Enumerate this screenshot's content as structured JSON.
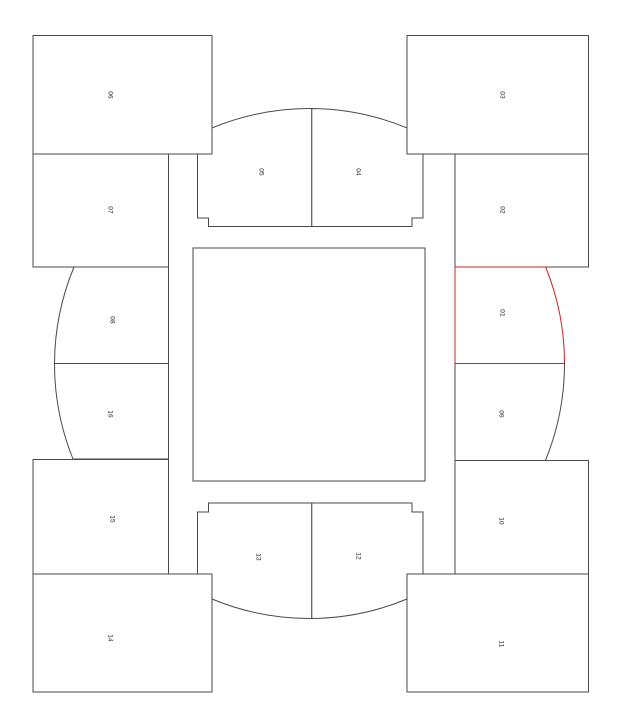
{
  "map": {
    "title": "venue-seating-map",
    "highlighted_section": "01",
    "field_label": ""
  },
  "colors": {
    "line": "#4a4a4a",
    "highlight": "#cc2525",
    "label": "#222222",
    "background": "#ffffff"
  },
  "sections": [
    {
      "id": "01",
      "label": "01",
      "highlighted": true
    },
    {
      "id": "02",
      "label": "02"
    },
    {
      "id": "03",
      "label": "03"
    },
    {
      "id": "04",
      "label": "04"
    },
    {
      "id": "05",
      "label": "05"
    },
    {
      "id": "06",
      "label": "06"
    },
    {
      "id": "07",
      "label": "07"
    },
    {
      "id": "08",
      "label": "08"
    },
    {
      "id": "09",
      "label": "09"
    },
    {
      "id": "10",
      "label": "10"
    },
    {
      "id": "11",
      "label": "11"
    },
    {
      "id": "12",
      "label": "12"
    },
    {
      "id": "13",
      "label": "13"
    },
    {
      "id": "14",
      "label": "14"
    },
    {
      "id": "15",
      "label": "15"
    },
    {
      "id": "16",
      "label": "16"
    }
  ]
}
